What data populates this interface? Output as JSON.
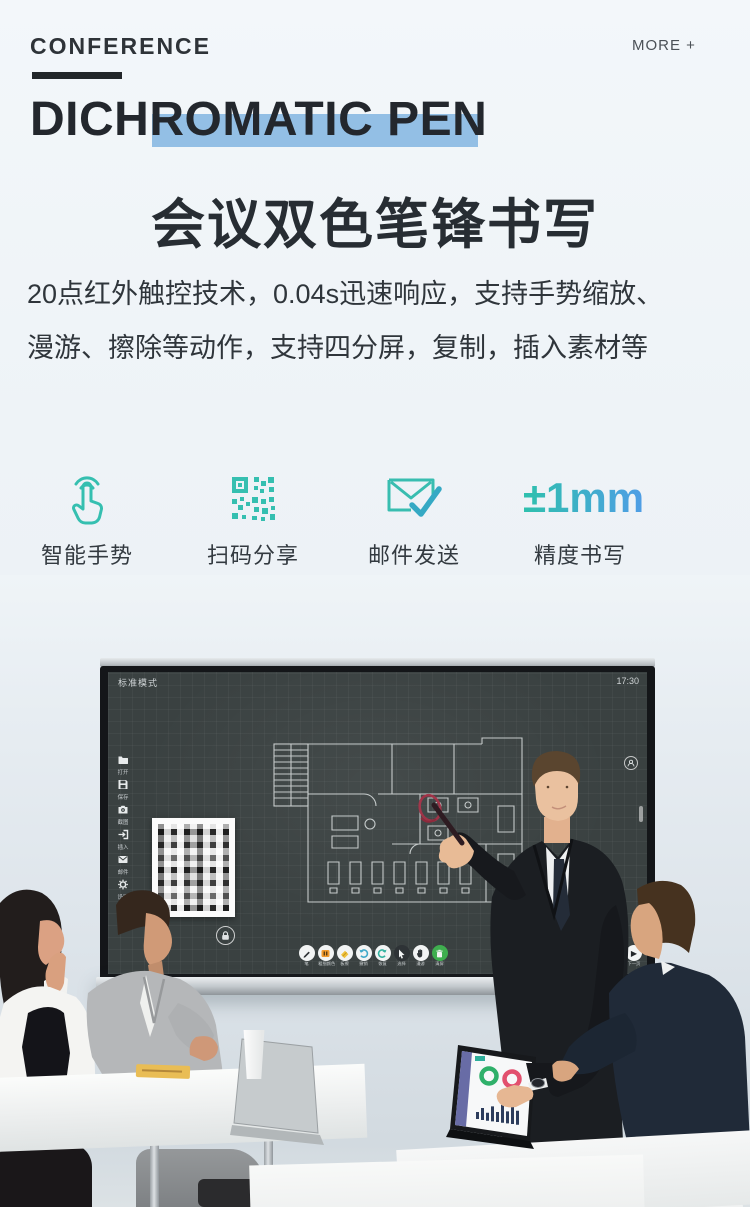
{
  "page": {
    "kicker": "CONFERENCE",
    "more_link": "MORE +",
    "title_en": "DICHROMATIC PEN",
    "title_zh": "会议双色笔锋书写",
    "desc_line1": "20点红外触控技术，0.04s迅速响应，支持手势缩放、",
    "desc_line2": "漫游、擦除等动作，支持四分屏，复制，插入素材等"
  },
  "features": [
    {
      "icon": "gesture-hand-icon",
      "label": "智能手势"
    },
    {
      "icon": "qr-code-icon",
      "label": "扫码分享"
    },
    {
      "icon": "mail-send-icon",
      "label": "邮件发送"
    },
    {
      "icon": "precision-value",
      "value": "±1mm",
      "label": "精度书写"
    }
  ],
  "whiteboard": {
    "mode_label": "标准模式",
    "clock": "17:30",
    "sidebar": [
      {
        "icon": "folder-icon",
        "label": "打开"
      },
      {
        "icon": "save-icon",
        "label": "保存"
      },
      {
        "icon": "screenshot-icon",
        "label": "截图"
      },
      {
        "icon": "insert-icon",
        "label": "插入"
      },
      {
        "icon": "mail-icon",
        "label": "邮件"
      },
      {
        "icon": "settings-icon",
        "label": "设置"
      },
      {
        "icon": "timer-icon",
        "label": "定时"
      }
    ],
    "toolbar": [
      {
        "icon": "pen-icon",
        "label": "笔"
      },
      {
        "icon": "thickness-color-icon",
        "label": "粗细颜色"
      },
      {
        "icon": "eraser-icon",
        "label": "板擦"
      },
      {
        "icon": "undo-icon",
        "label": "撤销"
      },
      {
        "icon": "redo-icon",
        "label": "恢复"
      },
      {
        "icon": "select-icon",
        "label": "选择"
      },
      {
        "icon": "pan-icon",
        "label": "漫游"
      },
      {
        "icon": "clear-icon",
        "label": "清屏"
      }
    ],
    "next_button_label": "下一页"
  },
  "colors": {
    "accent_teal": "#35bfb0",
    "accent_blue": "#4f9fe8",
    "title_highlight": "#83b5e2"
  }
}
